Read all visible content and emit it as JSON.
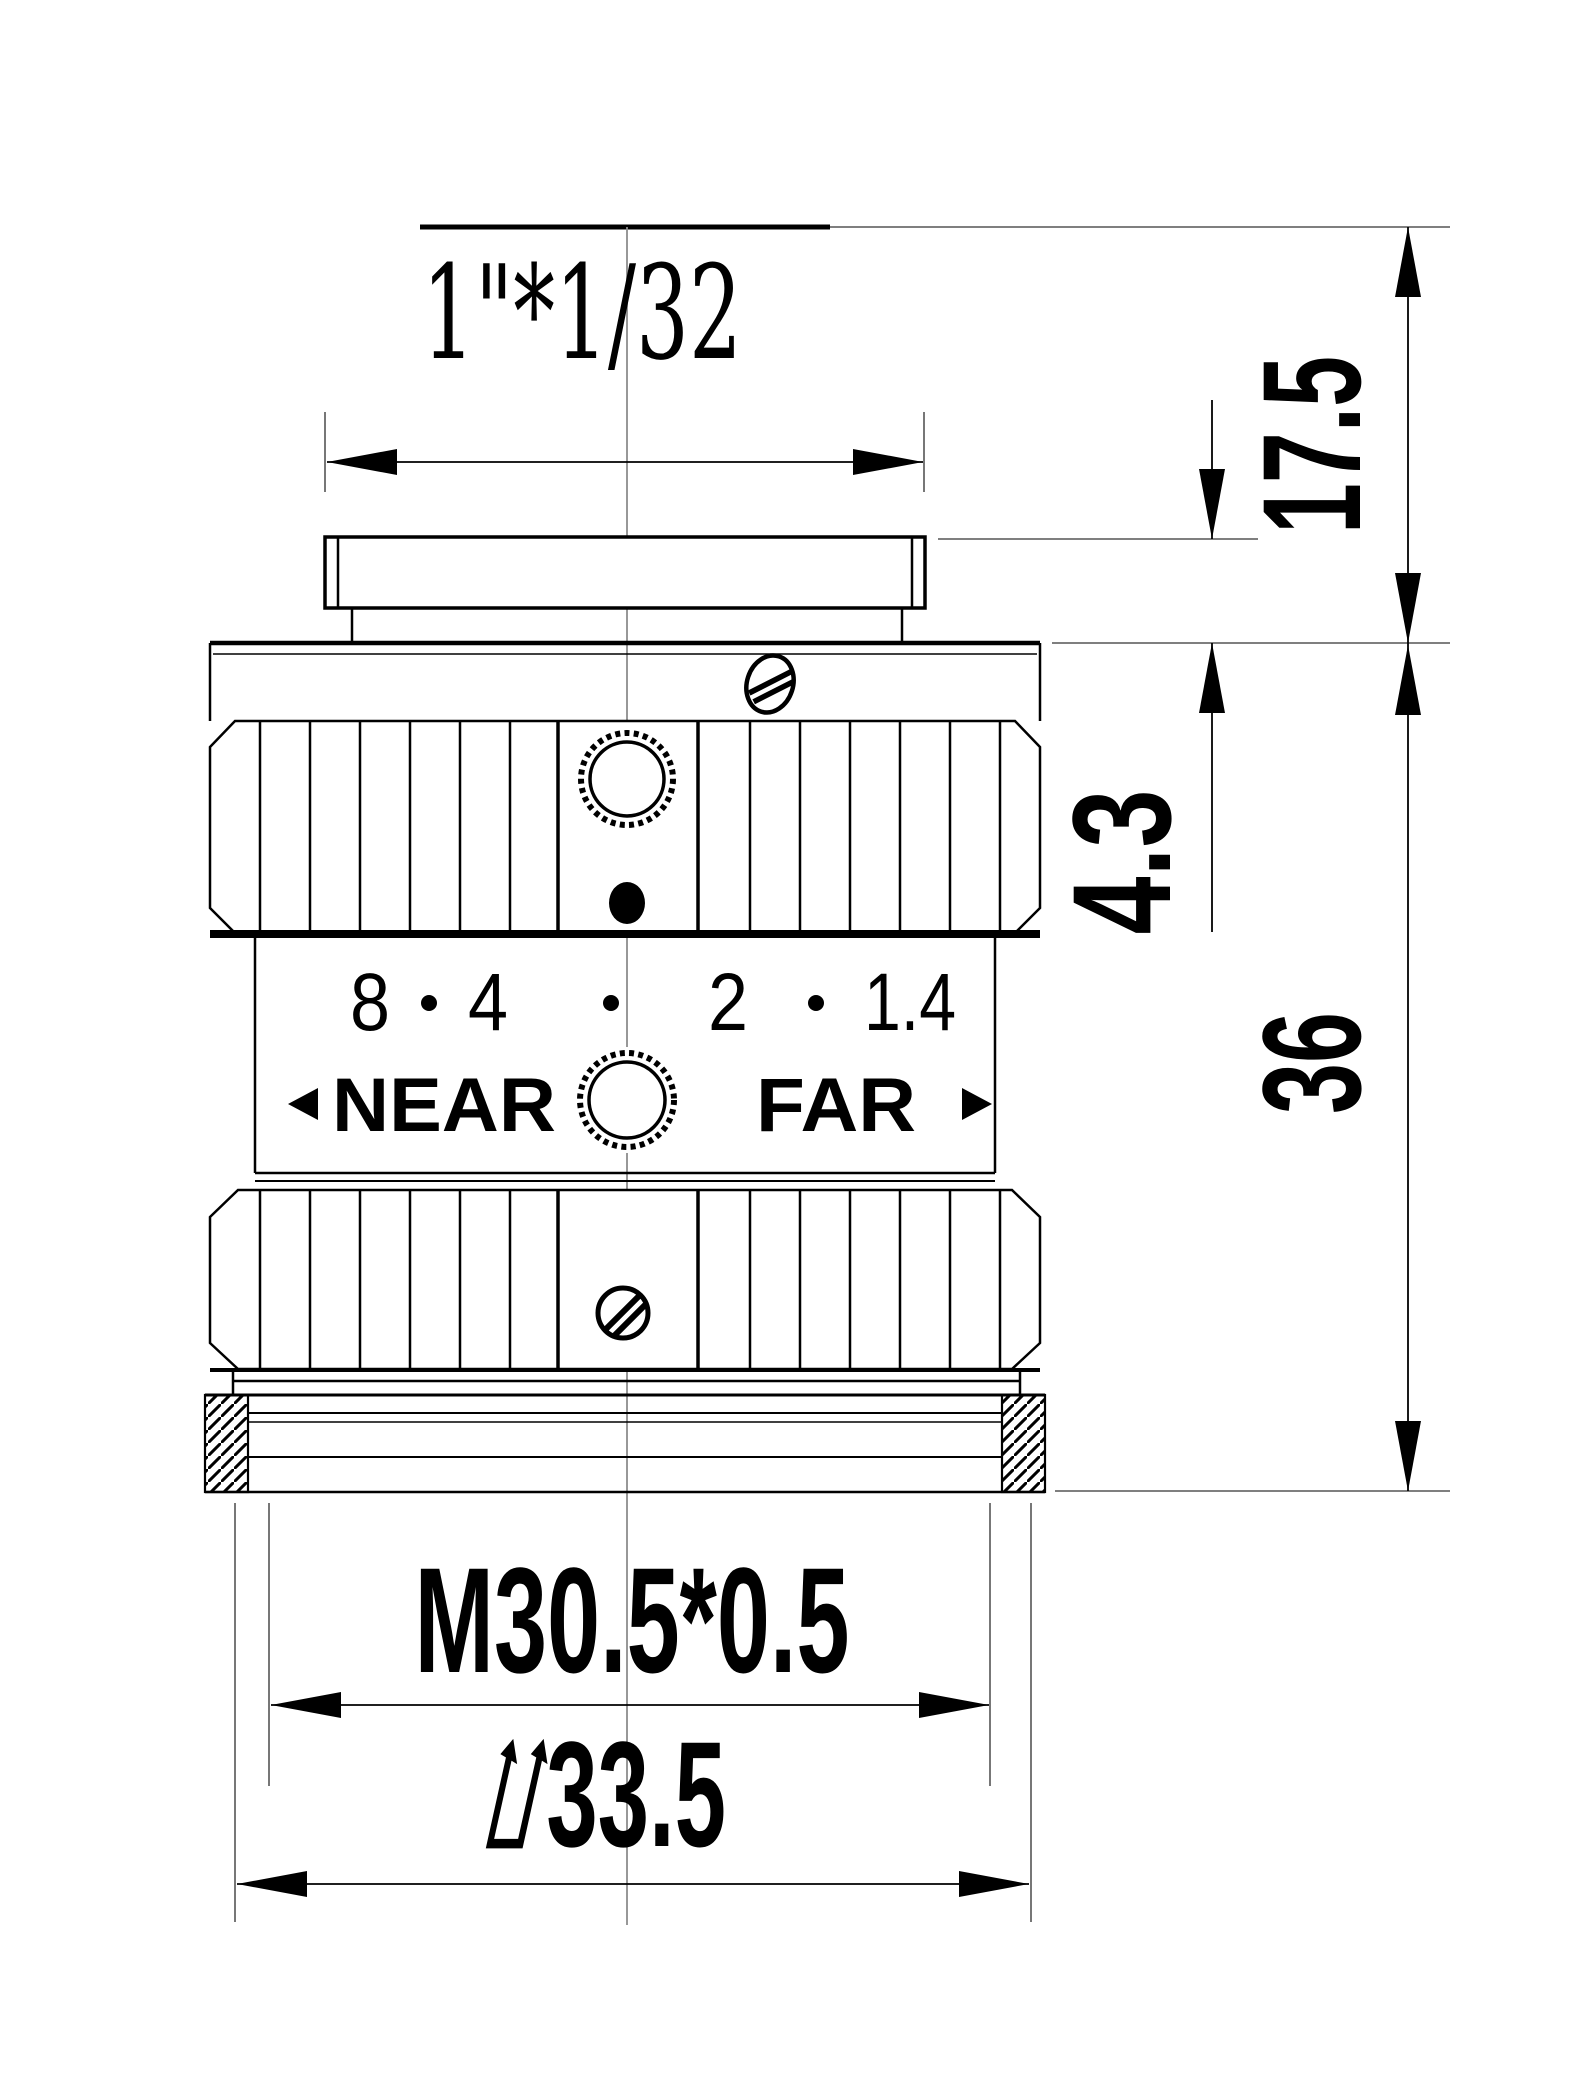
{
  "dimensions": {
    "mount_thread_label": "1\"*1/32",
    "flange_distance": "17.5",
    "shoulder_height": "4.3",
    "body_length": "36",
    "front_thread_label": "M30.5*0.5",
    "front_diameter_label": "⌰33.5"
  },
  "aperture_ring": {
    "scale_values": [
      "8",
      "4",
      "2",
      "1.4"
    ]
  },
  "focus_ring": {
    "near_label": "NEAR",
    "far_label": "FAR"
  },
  "colors": {
    "line": "#000000",
    "extension_line": "#555555",
    "centerline": "#8c8c8c",
    "background": "#ffffff"
  }
}
